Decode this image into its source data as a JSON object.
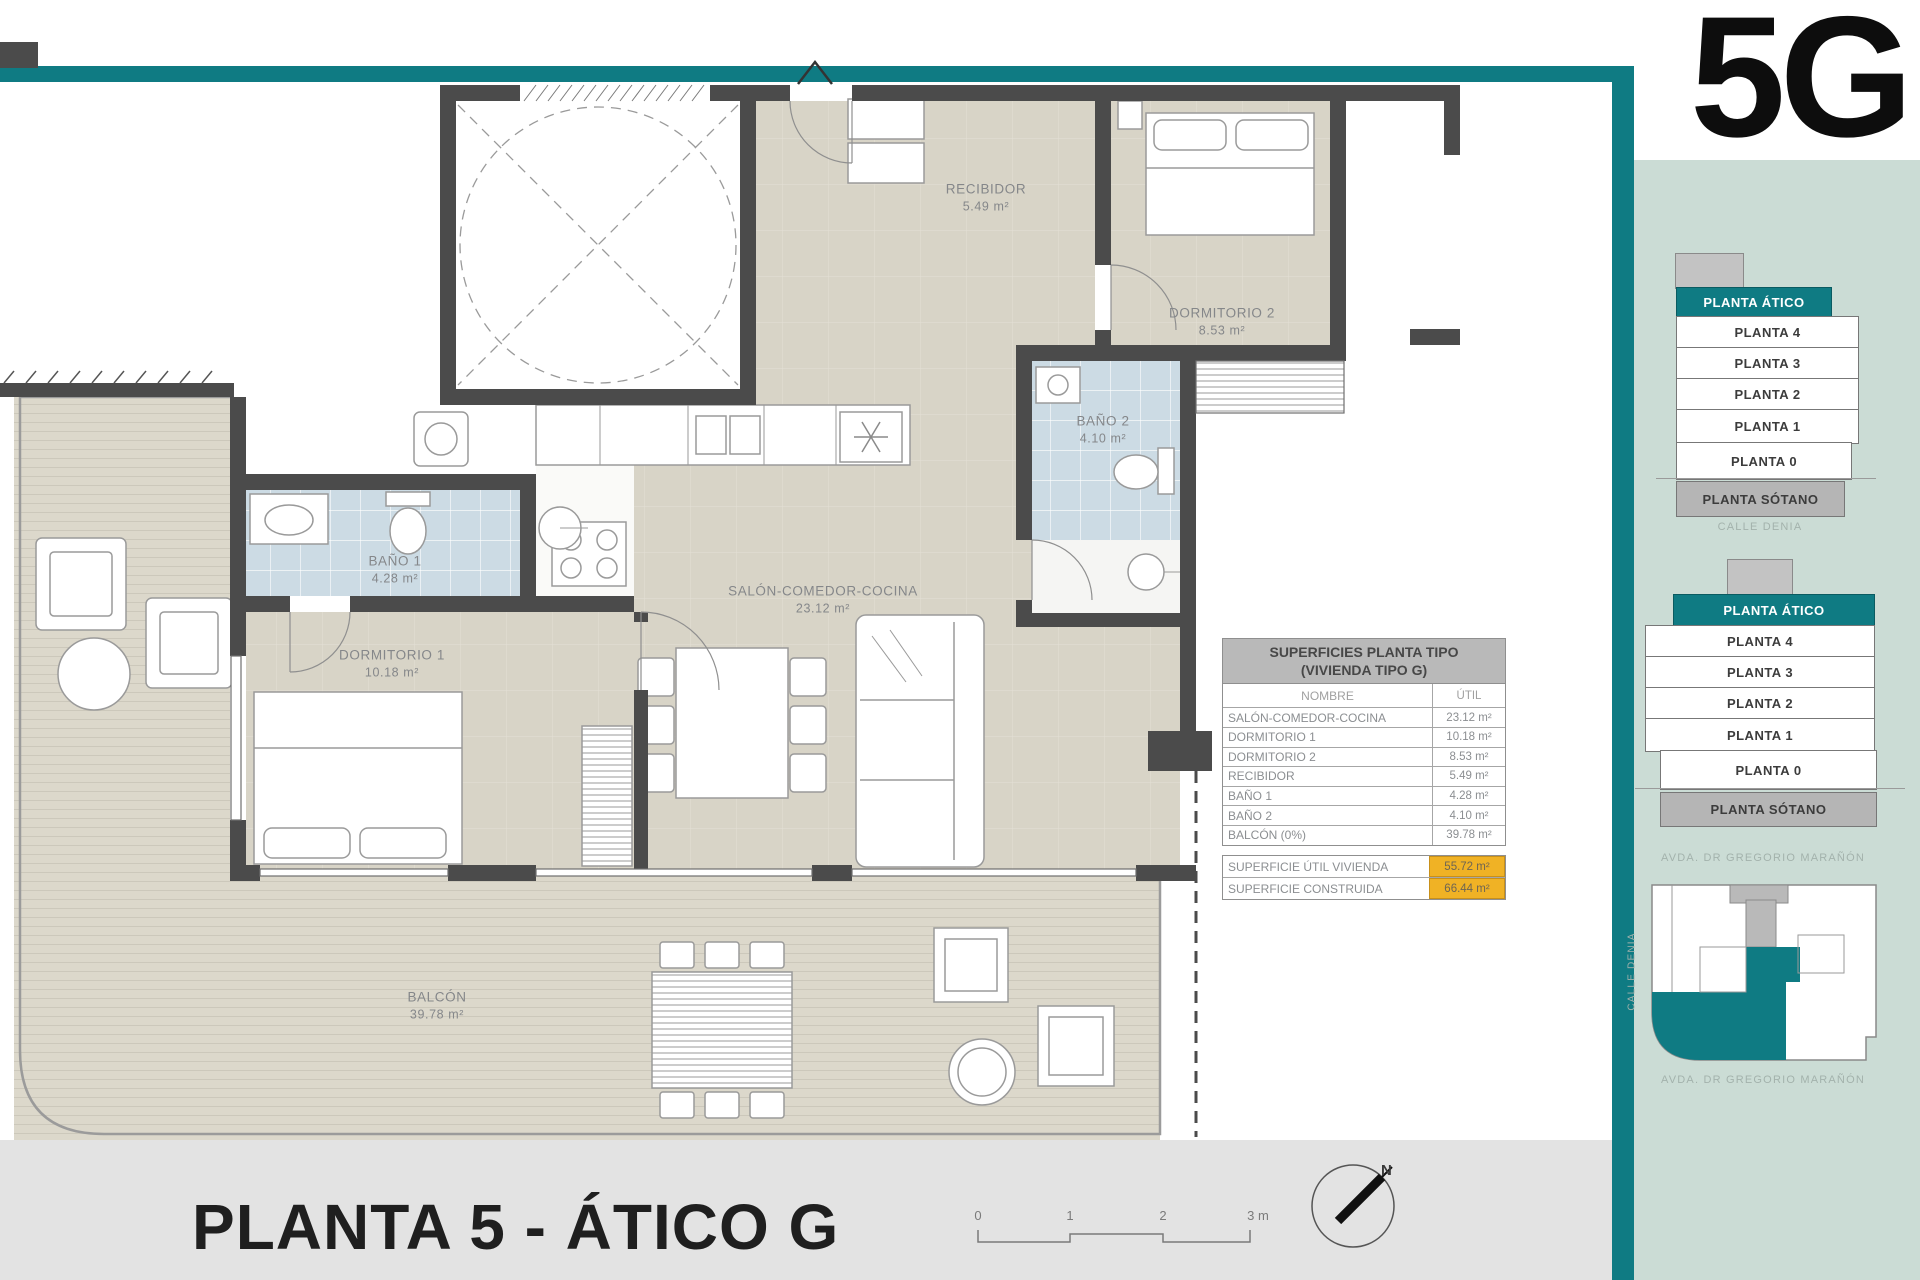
{
  "unit_code": "5G",
  "plan_title": "PLANTA 5 - ÁTICO G",
  "north_label": "N",
  "scale_bar": {
    "ticks": [
      "0",
      "1",
      "2",
      "3 m"
    ]
  },
  "rooms": {
    "recibidor": {
      "label": "RECIBIDOR",
      "area": "5.49 m²"
    },
    "dormitorio_2": {
      "label": "DORMITORIO 2",
      "area": "8.53 m²"
    },
    "bano_2": {
      "label": "BAÑO 2",
      "area": "4.10 m²"
    },
    "salon": {
      "label": "SALÓN-COMEDOR-COCINA",
      "area": "23.12 m²"
    },
    "bano_1": {
      "label": "BAÑO 1",
      "area": "4.28 m²"
    },
    "dormitorio_1": {
      "label": "DORMITORIO 1",
      "area": "10.18 m²"
    },
    "balcon": {
      "label": "BALCÓN",
      "area": "39.78 m²"
    }
  },
  "surfaces_table": {
    "title_line1": "SUPERFICIES PLANTA TIPO",
    "title_line2": "(VIVIENDA TIPO G)",
    "columns": {
      "name": "NOMBRE",
      "util": "ÚTIL"
    },
    "rows": [
      {
        "name": "SALÓN-COMEDOR-COCINA",
        "util": "23.12 m²"
      },
      {
        "name": "DORMITORIO 1",
        "util": "10.18 m²"
      },
      {
        "name": "DORMITORIO 2",
        "util": "8.53 m²"
      },
      {
        "name": "RECIBIDOR",
        "util": "5.49 m²"
      },
      {
        "name": "BAÑO 1",
        "util": "4.28 m²"
      },
      {
        "name": "BAÑO 2",
        "util": "4.10 m²"
      },
      {
        "name": "BALCÓN (0%)",
        "util": "39.78 m²"
      }
    ],
    "totals": [
      {
        "name": "SUPERFICIE ÚTIL VIVIENDA",
        "value": "55.72 m²"
      },
      {
        "name": "SUPERFICIE CONSTRUIDA",
        "value": "66.44 m²"
      }
    ]
  },
  "sidebar": {
    "stacks": [
      {
        "floors": [
          "PLANTA ÁTICO",
          "PLANTA 4",
          "PLANTA 3",
          "PLANTA 2",
          "PLANTA 1",
          "PLANTA 0",
          "PLANTA SÓTANO"
        ],
        "caption": "CALLE DENIA"
      },
      {
        "floors": [
          "PLANTA ÁTICO",
          "PLANTA 4",
          "PLANTA 3",
          "PLANTA 2",
          "PLANTA 1",
          "PLANTA 0",
          "PLANTA SÓTANO"
        ],
        "caption": "AVDA. DR GREGORIO MARAÑÓN"
      }
    ],
    "site_plan": {
      "street_side": "CALLE DENIA",
      "caption": "AVDA. DR GREGORIO MARAÑÓN"
    }
  },
  "colors": {
    "teal": "#0f7b83",
    "mint": "#cbdcd5",
    "wall": "#4b4b4b",
    "orange": "#f0b225"
  }
}
